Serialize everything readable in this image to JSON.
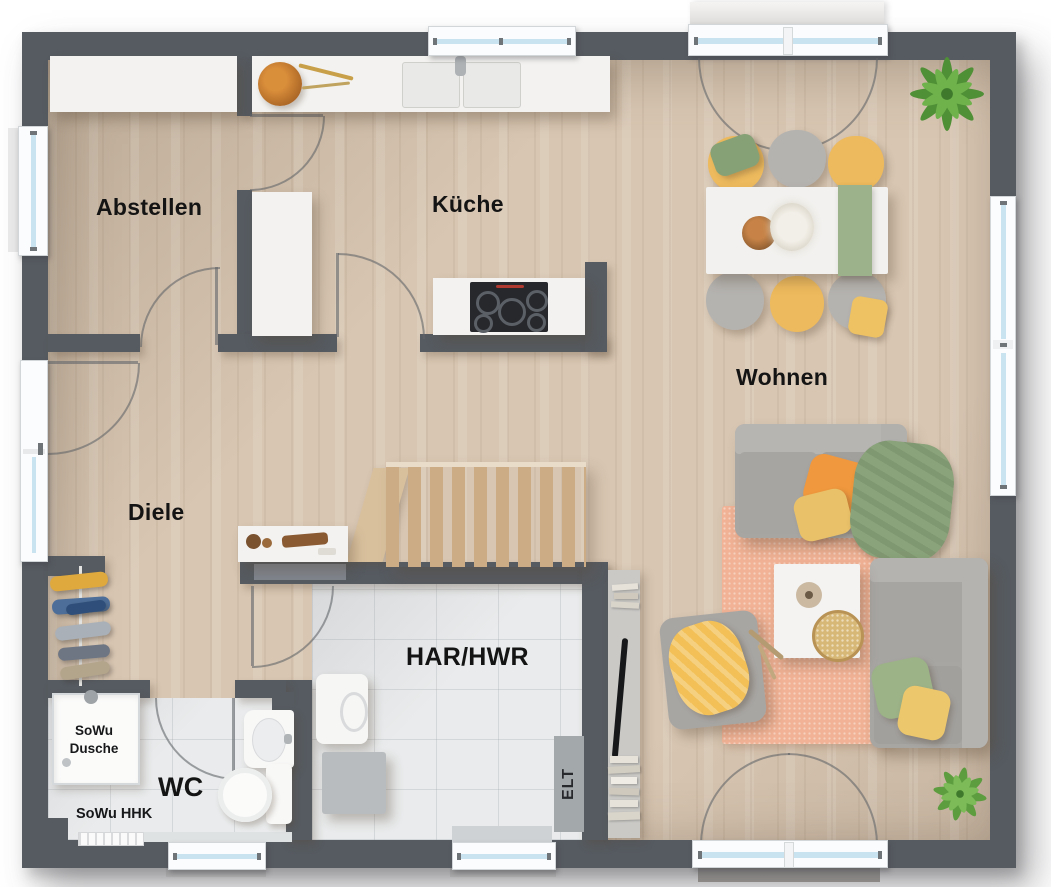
{
  "plan_type": "floor-plan-top-view",
  "labels": {
    "abstellen": "Abstellen",
    "kueche": "Küche",
    "wohnen": "Wohnen",
    "diele": "Diele",
    "har_hwr": "HAR/HWR",
    "wc": "WC",
    "sowu_dusche_1": "SoWu",
    "sowu_dusche_2": "Dusche",
    "sowu_hhk": "SoWu HHK",
    "elt": "ELT"
  },
  "rooms": [
    {
      "name": "Abstellen",
      "floor": "wood"
    },
    {
      "name": "Küche",
      "floor": "wood"
    },
    {
      "name": "Wohnen",
      "floor": "wood"
    },
    {
      "name": "Diele",
      "floor": "wood"
    },
    {
      "name": "HAR/HWR",
      "floor": "tile"
    },
    {
      "name": "WC",
      "floor": "tile"
    }
  ],
  "fixtures": [
    "kitchen-counter-with-sink",
    "cooktop-island",
    "tall-cabinet",
    "fruit-bowl",
    "dining-table-6-chairs",
    "staircase",
    "sideboard",
    "coat-rack",
    "shower",
    "toilet",
    "wash-basin",
    "towel-radiator",
    "washing-machine",
    "dryer-box",
    "electrical-panel",
    "tv-console",
    "sofa",
    "second-sofa",
    "armchair",
    "coffee-table",
    "rug",
    "plants",
    "entrance-door",
    "terrace-double-doors",
    "windows"
  ],
  "colors": {
    "wall": "#565b61",
    "wood_floor": "#d8c6b2",
    "tile_floor": "#e9ebec",
    "window_glass": "#c9e3f1",
    "rug": "#f1b295",
    "sofa_gray": "#a8a6a3",
    "chair_yellow": "#edba5d",
    "chair_gray": "#b5b3b0",
    "accent_orange": "#f0983d",
    "accent_green": "#8aa37a",
    "stair_wood": "#cfb088",
    "cooktop": "#26282c"
  }
}
